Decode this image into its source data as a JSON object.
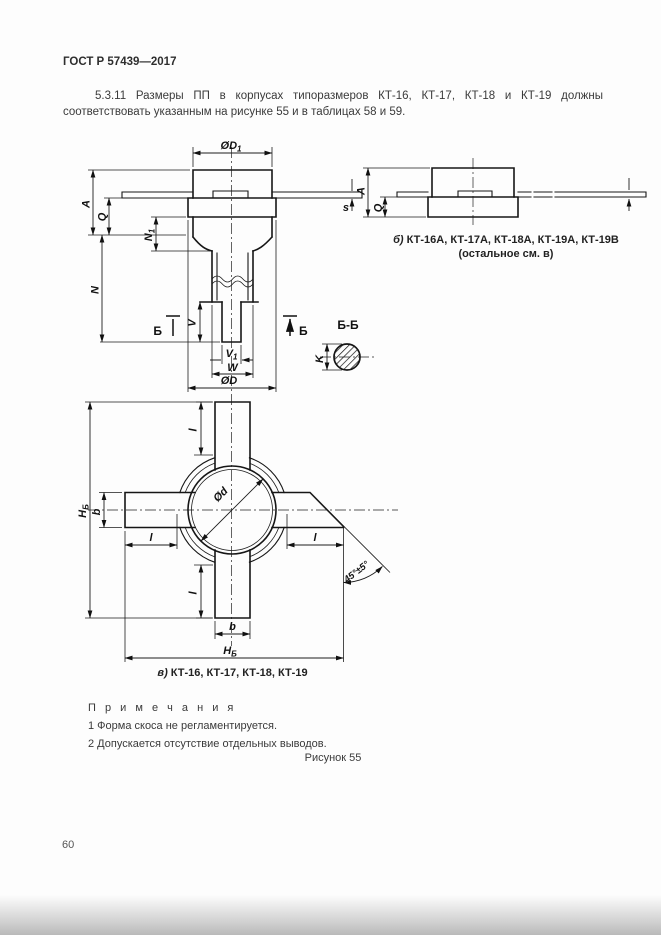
{
  "page": {
    "header_title": "ГОСТ Р 57439—2017",
    "paragraph": "5.3.11 Размеры ПП в корпусах типоразмеров КТ-16, КТ-17, КТ-18 и КТ-19 должны соответствовать указанным на рисунке 55 и в таблицах 58 и 59.",
    "notes_title": "П р и м е ч а н и я",
    "notes": [
      "1 Форма скоса не регламентируется.",
      "2 Допускается отсутствие отдельных выводов."
    ],
    "figure_label": "Рисунок 55",
    "page_number": "60"
  },
  "figure": {
    "view_a": {
      "dim_D1": {
        "main": "ØD",
        "sub": "1"
      },
      "dim_A": "A",
      "dim_Q": "Q",
      "dim_N1": {
        "main": "N",
        "sub": "1"
      },
      "dim_N": "N",
      "section_letter": "Б",
      "dim_V": "V",
      "dim_V1": {
        "main": "V",
        "sub": "1"
      },
      "dim_W": "W",
      "dim_D": "ØD",
      "dim_s": "s"
    },
    "view_b": {
      "dim_A": "A",
      "dim_Q": "Q",
      "caption_prefix": "б)",
      "caption_text": "КТ-16А, КТ-17А, КТ-18А, КТ-19А, КТ-19В",
      "caption_note": "(остальное см. в)"
    },
    "section_BB": {
      "title": "Б-Б",
      "dim_K": "K"
    },
    "view_v": {
      "dim_H": {
        "main": "Н",
        "sub": "Б"
      },
      "dim_b": "b",
      "dim_l": "l",
      "dim_diameter": "Ød",
      "angle": "45°±5°",
      "caption_prefix": "в)",
      "caption_text": "КТ-16, КТ-17, КТ-18, КТ-19"
    }
  }
}
